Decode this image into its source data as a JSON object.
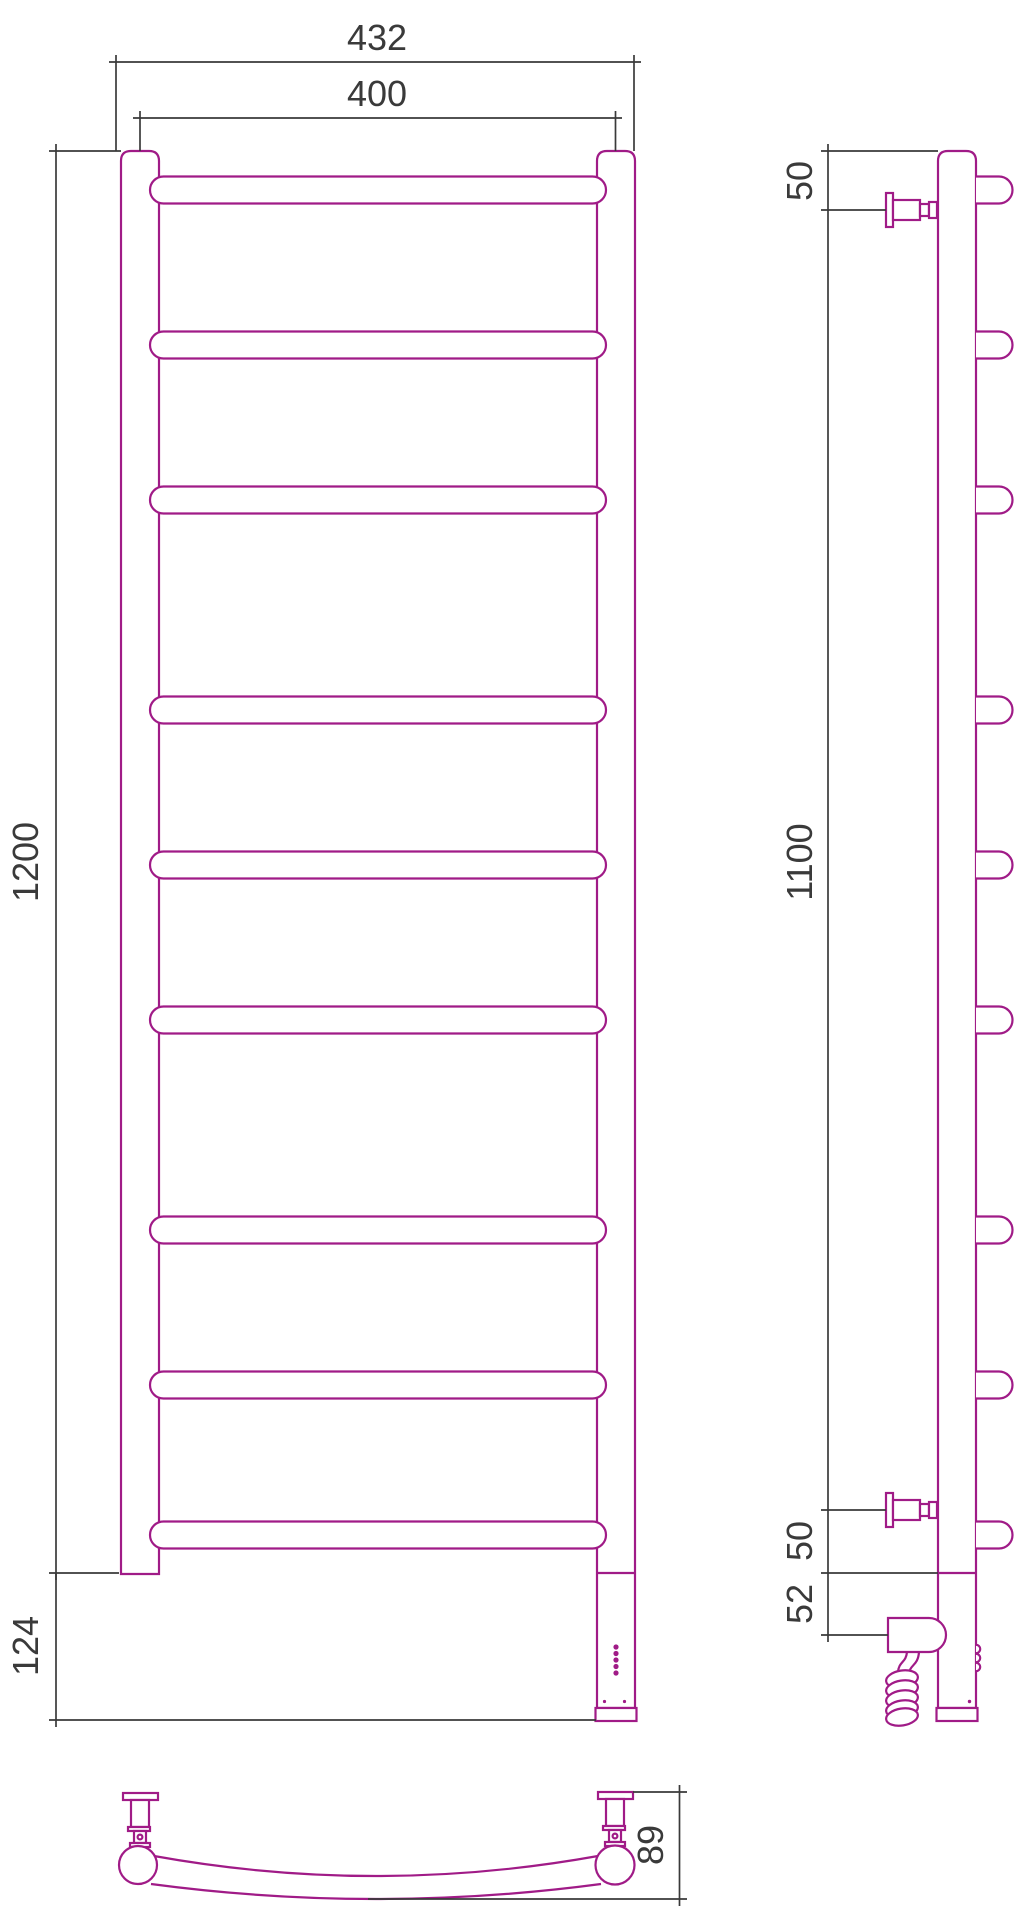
{
  "drawing": {
    "title": "Heated towel rail — dimensional drawing, three orthographic views",
    "views": {
      "front": {
        "rung_count": 9,
        "rung_groups": 3,
        "dimensions": {
          "overall_width": "432",
          "center_width": "400",
          "overall_height": "1200",
          "base_height": "124"
        }
      },
      "side": {
        "dimensions": {
          "top_bracket_offset": "50",
          "bracket_span": "1100",
          "bottom_bracket_offset": "50",
          "heater_offset": "52"
        }
      },
      "top": {
        "dimensions": {
          "depth": "89"
        }
      }
    },
    "colors": {
      "product_outline": "#A01B87",
      "dimension_lines": "#3A3A3A",
      "background": "#FFFFFF"
    }
  }
}
